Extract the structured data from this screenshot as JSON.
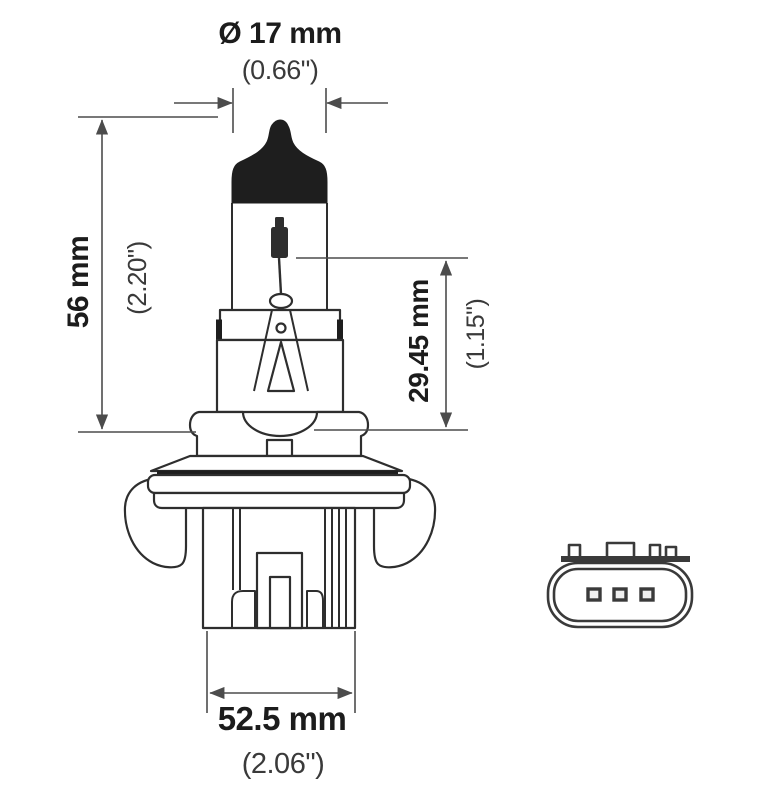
{
  "diagram": {
    "subject": "halogen-bulb-technical-drawing",
    "views": {
      "side_view": "bulb side profile with dimensions",
      "front_view": "base connector face with three pins"
    },
    "dimensions": {
      "diameter": {
        "metric": "Ø 17 mm",
        "imperial": "(0.66\")"
      },
      "overall_length": {
        "metric": "56 mm",
        "imperial": "(2.20\")"
      },
      "light_center_length": {
        "metric": "29.45 mm",
        "imperial": "(1.15\")"
      },
      "base_width": {
        "metric": "52.5 mm",
        "imperial": "(2.06\")"
      }
    },
    "connector": {
      "pin_count": "3"
    },
    "colors": {
      "background": "#ffffff",
      "outline": "#2e2e2e",
      "tip_fill": "#1e1e1e",
      "dimension_line": "#4c4c4c",
      "text_primary": "#1c1c1c",
      "text_secondary": "#3a3a3a"
    }
  }
}
